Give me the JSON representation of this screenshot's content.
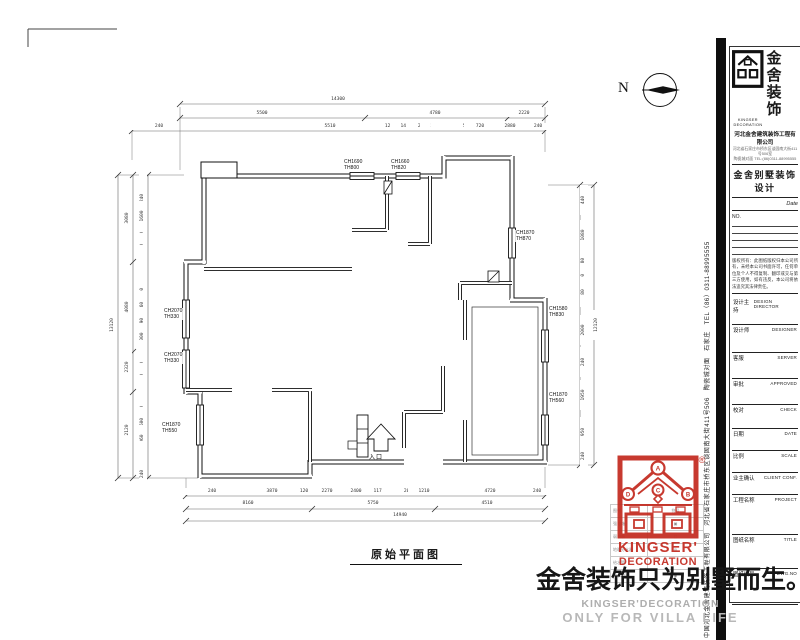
{
  "colors": {
    "ink": "#1a1a1a",
    "dim_line": "#666666",
    "brand_red": "#c32b20",
    "footer_grey": "#b3b3b3"
  },
  "north": {
    "label": "N"
  },
  "plan": {
    "title": "原始平面图",
    "entrance": "入口",
    "window_labels": [
      {
        "text": "CH1690\nTH800",
        "x": 343,
        "y": 159
      },
      {
        "text": "CH1660\nTH820",
        "x": 390,
        "y": 159
      },
      {
        "text": "CH1870\nTH870",
        "x": 515,
        "y": 230
      },
      {
        "text": "CH1580\nTH830",
        "x": 548,
        "y": 306
      },
      {
        "text": "CH1870\nTH560",
        "x": 548,
        "y": 392
      },
      {
        "text": "CH2070\nTH330",
        "x": 163,
        "y": 308
      },
      {
        "text": "CH2070\nTH330",
        "x": 163,
        "y": 352
      },
      {
        "text": "CH1870\nTH550",
        "x": 161,
        "y": 422
      }
    ]
  },
  "dims": {
    "h": [
      {
        "t": "14300",
        "x": 338,
        "y": 100
      },
      {
        "t": "5500",
        "x": 262,
        "y": 114
      },
      {
        "t": "4780",
        "x": 435,
        "y": 114
      },
      {
        "t": "2220",
        "x": 524,
        "y": 114
      },
      {
        "t": "240",
        "x": 137,
        "y": 127
      },
      {
        "t": "580",
        "x": 148,
        "y": 127
      },
      {
        "t": "240",
        "x": 159,
        "y": 127
      },
      {
        "t": "5510",
        "x": 330,
        "y": 127
      },
      {
        "t": "120",
        "x": 389,
        "y": 127
      },
      {
        "t": "1410",
        "x": 406,
        "y": 127
      },
      {
        "t": "280",
        "x": 422,
        "y": 127
      },
      {
        "t": "2800",
        "x": 436,
        "y": 127
      },
      {
        "t": "240",
        "x": 447,
        "y": 127
      },
      {
        "t": "505",
        "x": 457,
        "y": 127
      },
      {
        "t": "560",
        "x": 467,
        "y": 127
      },
      {
        "t": "720",
        "x": 480,
        "y": 127
      },
      {
        "t": "2880",
        "x": 510,
        "y": 127
      },
      {
        "t": "240",
        "x": 538,
        "y": 127
      },
      {
        "t": "240",
        "x": 190,
        "y": 492
      },
      {
        "t": "360",
        "x": 201,
        "y": 492
      },
      {
        "t": "240",
        "x": 212,
        "y": 492
      },
      {
        "t": "3870",
        "x": 272,
        "y": 492
      },
      {
        "t": "120",
        "x": 304,
        "y": 492
      },
      {
        "t": "2270",
        "x": 327,
        "y": 492
      },
      {
        "t": "2400",
        "x": 356,
        "y": 492
      },
      {
        "t": "1170",
        "x": 379,
        "y": 492
      },
      {
        "t": "100",
        "x": 398,
        "y": 492
      },
      {
        "t": "200",
        "x": 408,
        "y": 492
      },
      {
        "t": "1210",
        "x": 424,
        "y": 492
      },
      {
        "t": "4720",
        "x": 490,
        "y": 492
      },
      {
        "t": "240",
        "x": 537,
        "y": 492
      },
      {
        "t": "8160",
        "x": 248,
        "y": 504
      },
      {
        "t": "5750",
        "x": 373,
        "y": 504
      },
      {
        "t": "4510",
        "x": 487,
        "y": 504
      },
      {
        "t": "14940",
        "x": 400,
        "y": 516
      }
    ],
    "v": [
      {
        "t": "240",
        "x": 143,
        "y": 180
      },
      {
        "t": "570",
        "x": 143,
        "y": 189
      },
      {
        "t": "240",
        "x": 143,
        "y": 198
      },
      {
        "t": "1600",
        "x": 143,
        "y": 216
      },
      {
        "t": "240",
        "x": 143,
        "y": 236
      },
      {
        "t": "650",
        "x": 143,
        "y": 248
      },
      {
        "t": "350",
        "x": 143,
        "y": 260
      },
      {
        "t": "380",
        "x": 143,
        "y": 271
      },
      {
        "t": "240",
        "x": 143,
        "y": 281
      },
      {
        "t": "170",
        "x": 143,
        "y": 292
      },
      {
        "t": "860",
        "x": 143,
        "y": 306
      },
      {
        "t": "190",
        "x": 143,
        "y": 322
      },
      {
        "t": "1000",
        "x": 143,
        "y": 338
      },
      {
        "t": "380",
        "x": 143,
        "y": 355
      },
      {
        "t": "150",
        "x": 143,
        "y": 366
      },
      {
        "t": "390",
        "x": 143,
        "y": 378
      },
      {
        "t": "240",
        "x": 143,
        "y": 390
      },
      {
        "t": "350",
        "x": 143,
        "y": 400
      },
      {
        "t": "240",
        "x": 143,
        "y": 410
      },
      {
        "t": "600",
        "x": 143,
        "y": 422
      },
      {
        "t": "1060",
        "x": 143,
        "y": 440
      },
      {
        "t": "240",
        "x": 143,
        "y": 456
      },
      {
        "t": "360",
        "x": 143,
        "y": 465
      },
      {
        "t": "240",
        "x": 143,
        "y": 474
      },
      {
        "t": "3080",
        "x": 128,
        "y": 218
      },
      {
        "t": "4080",
        "x": 128,
        "y": 307
      },
      {
        "t": "2320",
        "x": 128,
        "y": 367
      },
      {
        "t": "2120",
        "x": 128,
        "y": 430
      },
      {
        "t": "13120",
        "x": 113,
        "y": 325
      },
      {
        "t": "440",
        "x": 584,
        "y": 200
      },
      {
        "t": "1080",
        "x": 584,
        "y": 235
      },
      {
        "t": "180",
        "x": 584,
        "y": 262
      },
      {
        "t": "150",
        "x": 584,
        "y": 278
      },
      {
        "t": "80",
        "x": 584,
        "y": 292
      },
      {
        "t": "2000",
        "x": 584,
        "y": 330
      },
      {
        "t": "240",
        "x": 584,
        "y": 362
      },
      {
        "t": "1950",
        "x": 584,
        "y": 395
      },
      {
        "t": "950",
        "x": 584,
        "y": 432
      },
      {
        "t": "240",
        "x": 584,
        "y": 456
      },
      {
        "t": "12120",
        "x": 597,
        "y": 325
      }
    ]
  },
  "title_block": {
    "brand_cn_top": "金舍",
    "brand_cn_bottom": "装饰",
    "logo_en_1": "KINGSER",
    "logo_en_2": "DECORATION",
    "company": "河北金舍建筑装饰工程有限公司",
    "addr_line1": "河北省石家庄市桥东区谈固南大街411号506室",
    "addr_line2": "陶瓷城对面 TEL:(86)0311-88995555",
    "subtitle": "金舍别墅装饰设计",
    "date_label": "Date",
    "no_label": "NO.",
    "notice": "版权所有：此图纸版权归本公司所有，未经本公司书面许可，任何单位及个人不得复制、翻印或交与第三方使用，如有违反，本公司将依法追究其法律责任。",
    "rows": [
      {
        "cn": "设计主持",
        "en": "DESIGN DIRECTOR",
        "h": 28
      },
      {
        "cn": "设计师",
        "en": "DESIGNER",
        "h": 28
      },
      {
        "cn": "客服",
        "en": "SERVER",
        "h": 26
      },
      {
        "cn": "审批",
        "en": "APPROVED",
        "h": 26
      },
      {
        "cn": "校对",
        "en": "CHECK",
        "h": 24
      },
      {
        "cn": "日期",
        "en": "DATE",
        "h": 22
      },
      {
        "cn": "比例",
        "en": "SCALE",
        "h": 22
      },
      {
        "cn": "业主确认",
        "en": "CLIENT CONF.",
        "h": 22
      },
      {
        "cn": "工程名称",
        "en": "PROJECT",
        "h": 40
      },
      {
        "cn": "图纸名称",
        "en": "TITLE",
        "h": 34
      },
      {
        "cn": "图纸编号",
        "en": "DWG.NO",
        "h": 36
      }
    ],
    "side_text": "中国河北金舍建筑装饰工程有限公司　河北省石家庄市桥东区谈固南大街411号506　陶瓷城对面　石家庄　TEL（86）0311-88995555"
  },
  "watermark": {
    "reg": "®",
    "brand1": "KINGSER'",
    "brand2": "DECORATION",
    "circles": [
      "A",
      "D",
      "B",
      "C"
    ],
    "legend": [
      [
        "图例",
        "符号"
      ],
      [
        "强电箱",
        "▣"
      ],
      [
        "弱电箱",
        "▢"
      ],
      [
        "地暖分水器",
        "◎"
      ],
      [
        "给水管",
        "—"
      ],
      [
        "排水地漏",
        "◉"
      ]
    ]
  },
  "footer": {
    "slogan": "金舍装饰只为别墅而生。",
    "en1": "KINGSER'DECORATION",
    "en2": "ONLY FOR VILLA LIFE"
  }
}
